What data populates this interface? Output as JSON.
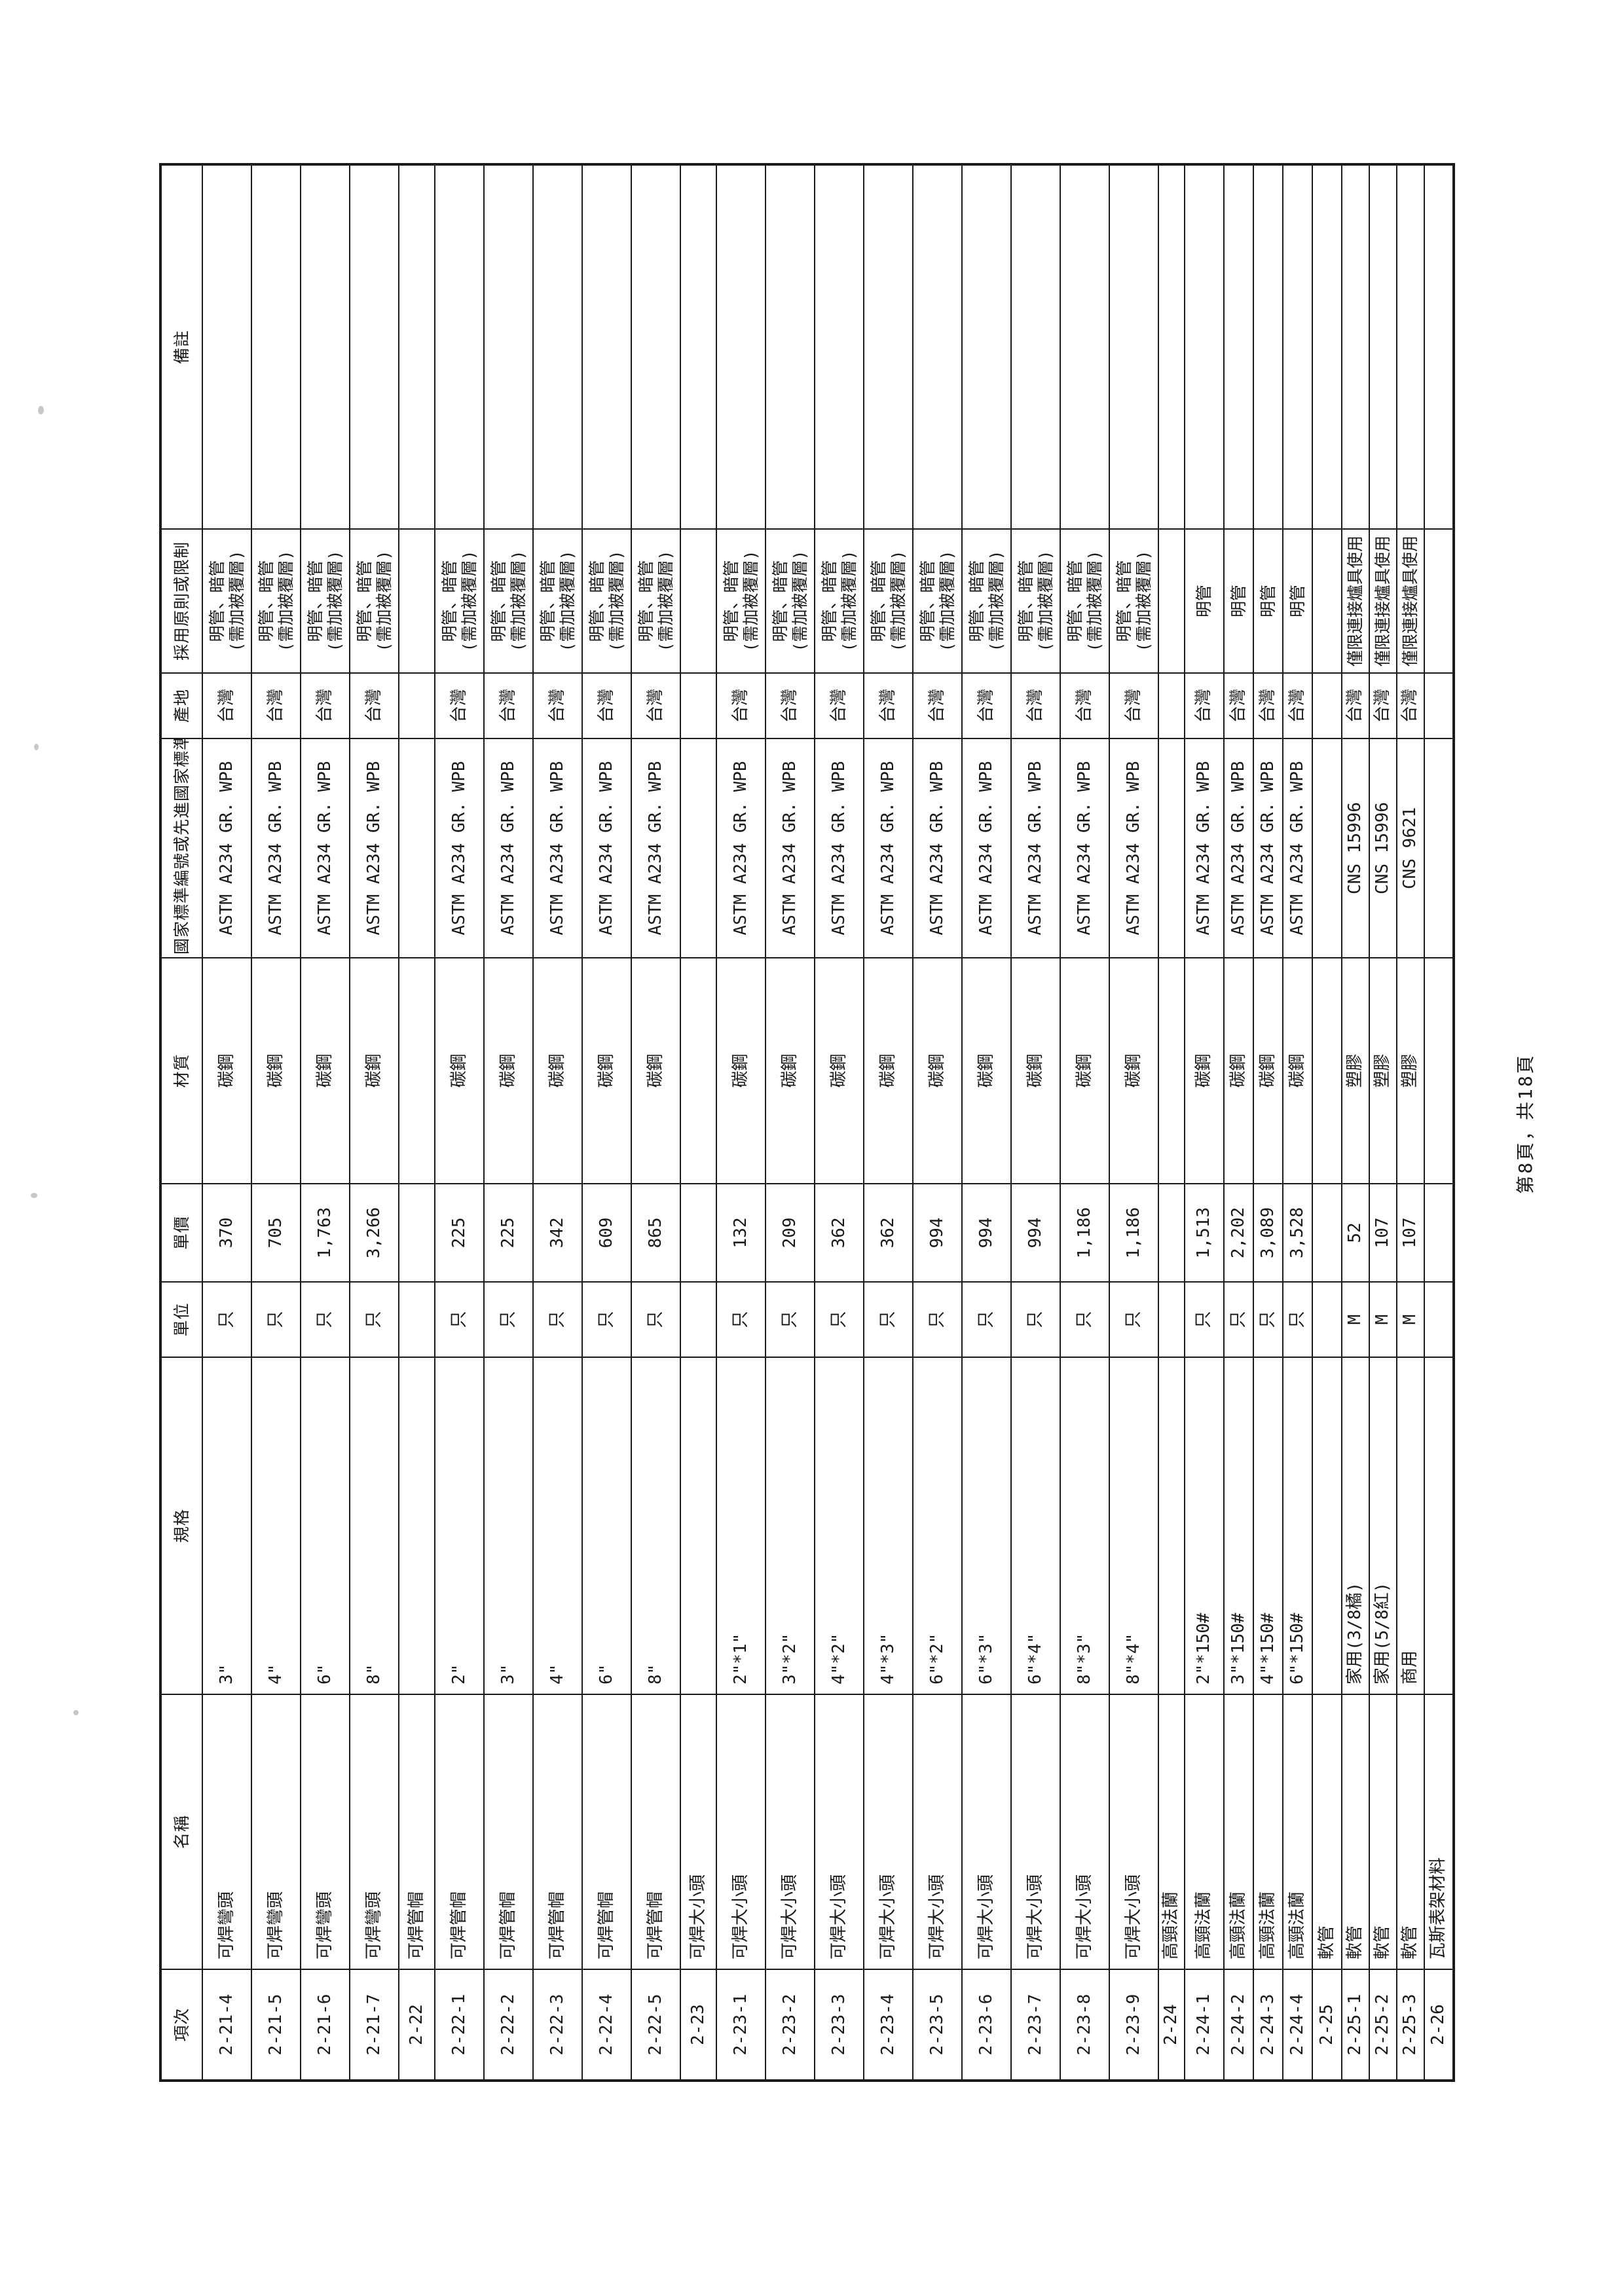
{
  "page": {
    "footer": "第8頁，共18頁"
  },
  "colors": {
    "paper": "#ffffff",
    "ink": "#1a1a1a"
  },
  "table": {
    "headers": [
      "項次",
      "名稱",
      "規格",
      "單位",
      "單價",
      "材質",
      "國家標準編號或先進國家標準",
      "產地",
      "採用原則或限制",
      "備註"
    ],
    "rows": [
      {
        "no": "2-21-4",
        "name": "可焊彎頭",
        "spec": "3\"",
        "unit": "只",
        "price": "370",
        "material": "碳鋼",
        "standard": "ASTM A234 GR. WPB",
        "origin": "台灣",
        "rule": [
          "明管、暗管",
          "(需加被覆層)"
        ],
        "remark": "",
        "section": false
      },
      {
        "no": "2-21-5",
        "name": "可焊彎頭",
        "spec": "4\"",
        "unit": "只",
        "price": "705",
        "material": "碳鋼",
        "standard": "ASTM A234 GR. WPB",
        "origin": "台灣",
        "rule": [
          "明管、暗管",
          "(需加被覆層)"
        ],
        "remark": "",
        "section": false
      },
      {
        "no": "2-21-6",
        "name": "可焊彎頭",
        "spec": "6\"",
        "unit": "只",
        "price": "1,763",
        "material": "碳鋼",
        "standard": "ASTM A234 GR. WPB",
        "origin": "台灣",
        "rule": [
          "明管、暗管",
          "(需加被覆層)"
        ],
        "remark": "",
        "section": false
      },
      {
        "no": "2-21-7",
        "name": "可焊彎頭",
        "spec": "8\"",
        "unit": "只",
        "price": "3,266",
        "material": "碳鋼",
        "standard": "ASTM A234 GR. WPB",
        "origin": "台灣",
        "rule": [
          "明管、暗管",
          "(需加被覆層)"
        ],
        "remark": "",
        "section": false
      },
      {
        "no": "2-22",
        "name": "可焊管帽",
        "spec": "",
        "unit": "",
        "price": "",
        "material": "",
        "standard": "",
        "origin": "",
        "rule": [],
        "remark": "",
        "section": true
      },
      {
        "no": "2-22-1",
        "name": "可焊管帽",
        "spec": "2\"",
        "unit": "只",
        "price": "225",
        "material": "碳鋼",
        "standard": "ASTM A234 GR. WPB",
        "origin": "台灣",
        "rule": [
          "明管、暗管",
          "(需加被覆層)"
        ],
        "remark": "",
        "section": false
      },
      {
        "no": "2-22-2",
        "name": "可焊管帽",
        "spec": "3\"",
        "unit": "只",
        "price": "225",
        "material": "碳鋼",
        "standard": "ASTM A234 GR. WPB",
        "origin": "台灣",
        "rule": [
          "明管、暗管",
          "(需加被覆層)"
        ],
        "remark": "",
        "section": false
      },
      {
        "no": "2-22-3",
        "name": "可焊管帽",
        "spec": "4\"",
        "unit": "只",
        "price": "342",
        "material": "碳鋼",
        "standard": "ASTM A234 GR. WPB",
        "origin": "台灣",
        "rule": [
          "明管、暗管",
          "(需加被覆層)"
        ],
        "remark": "",
        "section": false
      },
      {
        "no": "2-22-4",
        "name": "可焊管帽",
        "spec": "6\"",
        "unit": "只",
        "price": "609",
        "material": "碳鋼",
        "standard": "ASTM A234 GR. WPB",
        "origin": "台灣",
        "rule": [
          "明管、暗管",
          "(需加被覆層)"
        ],
        "remark": "",
        "section": false
      },
      {
        "no": "2-22-5",
        "name": "可焊管帽",
        "spec": "8\"",
        "unit": "只",
        "price": "865",
        "material": "碳鋼",
        "standard": "ASTM A234 GR. WPB",
        "origin": "台灣",
        "rule": [
          "明管、暗管",
          "(需加被覆層)"
        ],
        "remark": "",
        "section": false
      },
      {
        "no": "2-23",
        "name": "可焊大小頭",
        "spec": "",
        "unit": "",
        "price": "",
        "material": "",
        "standard": "",
        "origin": "",
        "rule": [],
        "remark": "",
        "section": true
      },
      {
        "no": "2-23-1",
        "name": "可焊大小頭",
        "spec": "2\"*1\"",
        "unit": "只",
        "price": "132",
        "material": "碳鋼",
        "standard": "ASTM A234 GR. WPB",
        "origin": "台灣",
        "rule": [
          "明管、暗管",
          "(需加被覆層)"
        ],
        "remark": "",
        "section": false
      },
      {
        "no": "2-23-2",
        "name": "可焊大小頭",
        "spec": "3\"*2\"",
        "unit": "只",
        "price": "209",
        "material": "碳鋼",
        "standard": "ASTM A234 GR. WPB",
        "origin": "台灣",
        "rule": [
          "明管、暗管",
          "(需加被覆層)"
        ],
        "remark": "",
        "section": false
      },
      {
        "no": "2-23-3",
        "name": "可焊大小頭",
        "spec": "4\"*2\"",
        "unit": "只",
        "price": "362",
        "material": "碳鋼",
        "standard": "ASTM A234 GR. WPB",
        "origin": "台灣",
        "rule": [
          "明管、暗管",
          "(需加被覆層)"
        ],
        "remark": "",
        "section": false
      },
      {
        "no": "2-23-4",
        "name": "可焊大小頭",
        "spec": "4\"*3\"",
        "unit": "只",
        "price": "362",
        "material": "碳鋼",
        "standard": "ASTM A234 GR. WPB",
        "origin": "台灣",
        "rule": [
          "明管、暗管",
          "(需加被覆層)"
        ],
        "remark": "",
        "section": false
      },
      {
        "no": "2-23-5",
        "name": "可焊大小頭",
        "spec": "6\"*2\"",
        "unit": "只",
        "price": "994",
        "material": "碳鋼",
        "standard": "ASTM A234 GR. WPB",
        "origin": "台灣",
        "rule": [
          "明管、暗管",
          "(需加被覆層)"
        ],
        "remark": "",
        "section": false
      },
      {
        "no": "2-23-6",
        "name": "可焊大小頭",
        "spec": "6\"*3\"",
        "unit": "只",
        "price": "994",
        "material": "碳鋼",
        "standard": "ASTM A234 GR. WPB",
        "origin": "台灣",
        "rule": [
          "明管、暗管",
          "(需加被覆層)"
        ],
        "remark": "",
        "section": false
      },
      {
        "no": "2-23-7",
        "name": "可焊大小頭",
        "spec": "6\"*4\"",
        "unit": "只",
        "price": "994",
        "material": "碳鋼",
        "standard": "ASTM A234 GR. WPB",
        "origin": "台灣",
        "rule": [
          "明管、暗管",
          "(需加被覆層)"
        ],
        "remark": "",
        "section": false
      },
      {
        "no": "2-23-8",
        "name": "可焊大小頭",
        "spec": "8\"*3\"",
        "unit": "只",
        "price": "1,186",
        "material": "碳鋼",
        "standard": "ASTM A234 GR. WPB",
        "origin": "台灣",
        "rule": [
          "明管、暗管",
          "(需加被覆層)"
        ],
        "remark": "",
        "section": false
      },
      {
        "no": "2-23-9",
        "name": "可焊大小頭",
        "spec": "8\"*4\"",
        "unit": "只",
        "price": "1,186",
        "material": "碳鋼",
        "standard": "ASTM A234 GR. WPB",
        "origin": "台灣",
        "rule": [
          "明管、暗管",
          "(需加被覆層)"
        ],
        "remark": "",
        "section": false
      },
      {
        "no": "2-24",
        "name": "高頸法蘭",
        "spec": "",
        "unit": "",
        "price": "",
        "material": "",
        "standard": "",
        "origin": "",
        "rule": [],
        "remark": "",
        "section": true
      },
      {
        "no": "2-24-1",
        "name": "高頸法蘭",
        "spec": "2\"*150#",
        "unit": "只",
        "price": "1,513",
        "material": "碳鋼",
        "standard": "ASTM A234 GR. WPB",
        "origin": "台灣",
        "rule": [
          "明管"
        ],
        "remark": "",
        "section": false
      },
      {
        "no": "2-24-2",
        "name": "高頸法蘭",
        "spec": "3\"*150#",
        "unit": "只",
        "price": "2,202",
        "material": "碳鋼",
        "standard": "ASTM A234 GR. WPB",
        "origin": "台灣",
        "rule": [
          "明管"
        ],
        "remark": "",
        "section": false
      },
      {
        "no": "2-24-3",
        "name": "高頸法蘭",
        "spec": "4\"*150#",
        "unit": "只",
        "price": "3,089",
        "material": "碳鋼",
        "standard": "ASTM A234 GR. WPB",
        "origin": "台灣",
        "rule": [
          "明管"
        ],
        "remark": "",
        "section": false
      },
      {
        "no": "2-24-4",
        "name": "高頸法蘭",
        "spec": "6\"*150#",
        "unit": "只",
        "price": "3,528",
        "material": "碳鋼",
        "standard": "ASTM A234 GR. WPB",
        "origin": "台灣",
        "rule": [
          "明管"
        ],
        "remark": "",
        "section": false
      },
      {
        "no": "2-25",
        "name": "軟管",
        "spec": "",
        "unit": "",
        "price": "",
        "material": "",
        "standard": "",
        "origin": "",
        "rule": [],
        "remark": "",
        "section": true
      },
      {
        "no": "2-25-1",
        "name": "軟管",
        "spec": "家用(3/8橘)",
        "unit": "M",
        "price": "52",
        "material": "塑膠",
        "standard": "CNS 15996",
        "origin": "台灣",
        "rule": [
          "僅限連接爐具使用"
        ],
        "remark": "",
        "section": false
      },
      {
        "no": "2-25-2",
        "name": "軟管",
        "spec": "家用(5/8紅)",
        "unit": "M",
        "price": "107",
        "material": "塑膠",
        "standard": "CNS 15996",
        "origin": "台灣",
        "rule": [
          "僅限連接爐具使用"
        ],
        "remark": "",
        "section": false
      },
      {
        "no": "2-25-3",
        "name": "軟管",
        "spec": "商用",
        "unit": "M",
        "price": "107",
        "material": "塑膠",
        "standard": "CNS 9621",
        "origin": "台灣",
        "rule": [
          "僅限連接爐具使用"
        ],
        "remark": "",
        "section": false
      },
      {
        "no": "2-26",
        "name": "瓦斯表架材料",
        "spec": "",
        "unit": "",
        "price": "",
        "material": "",
        "standard": "",
        "origin": "",
        "rule": [],
        "remark": "",
        "section": true
      }
    ]
  }
}
